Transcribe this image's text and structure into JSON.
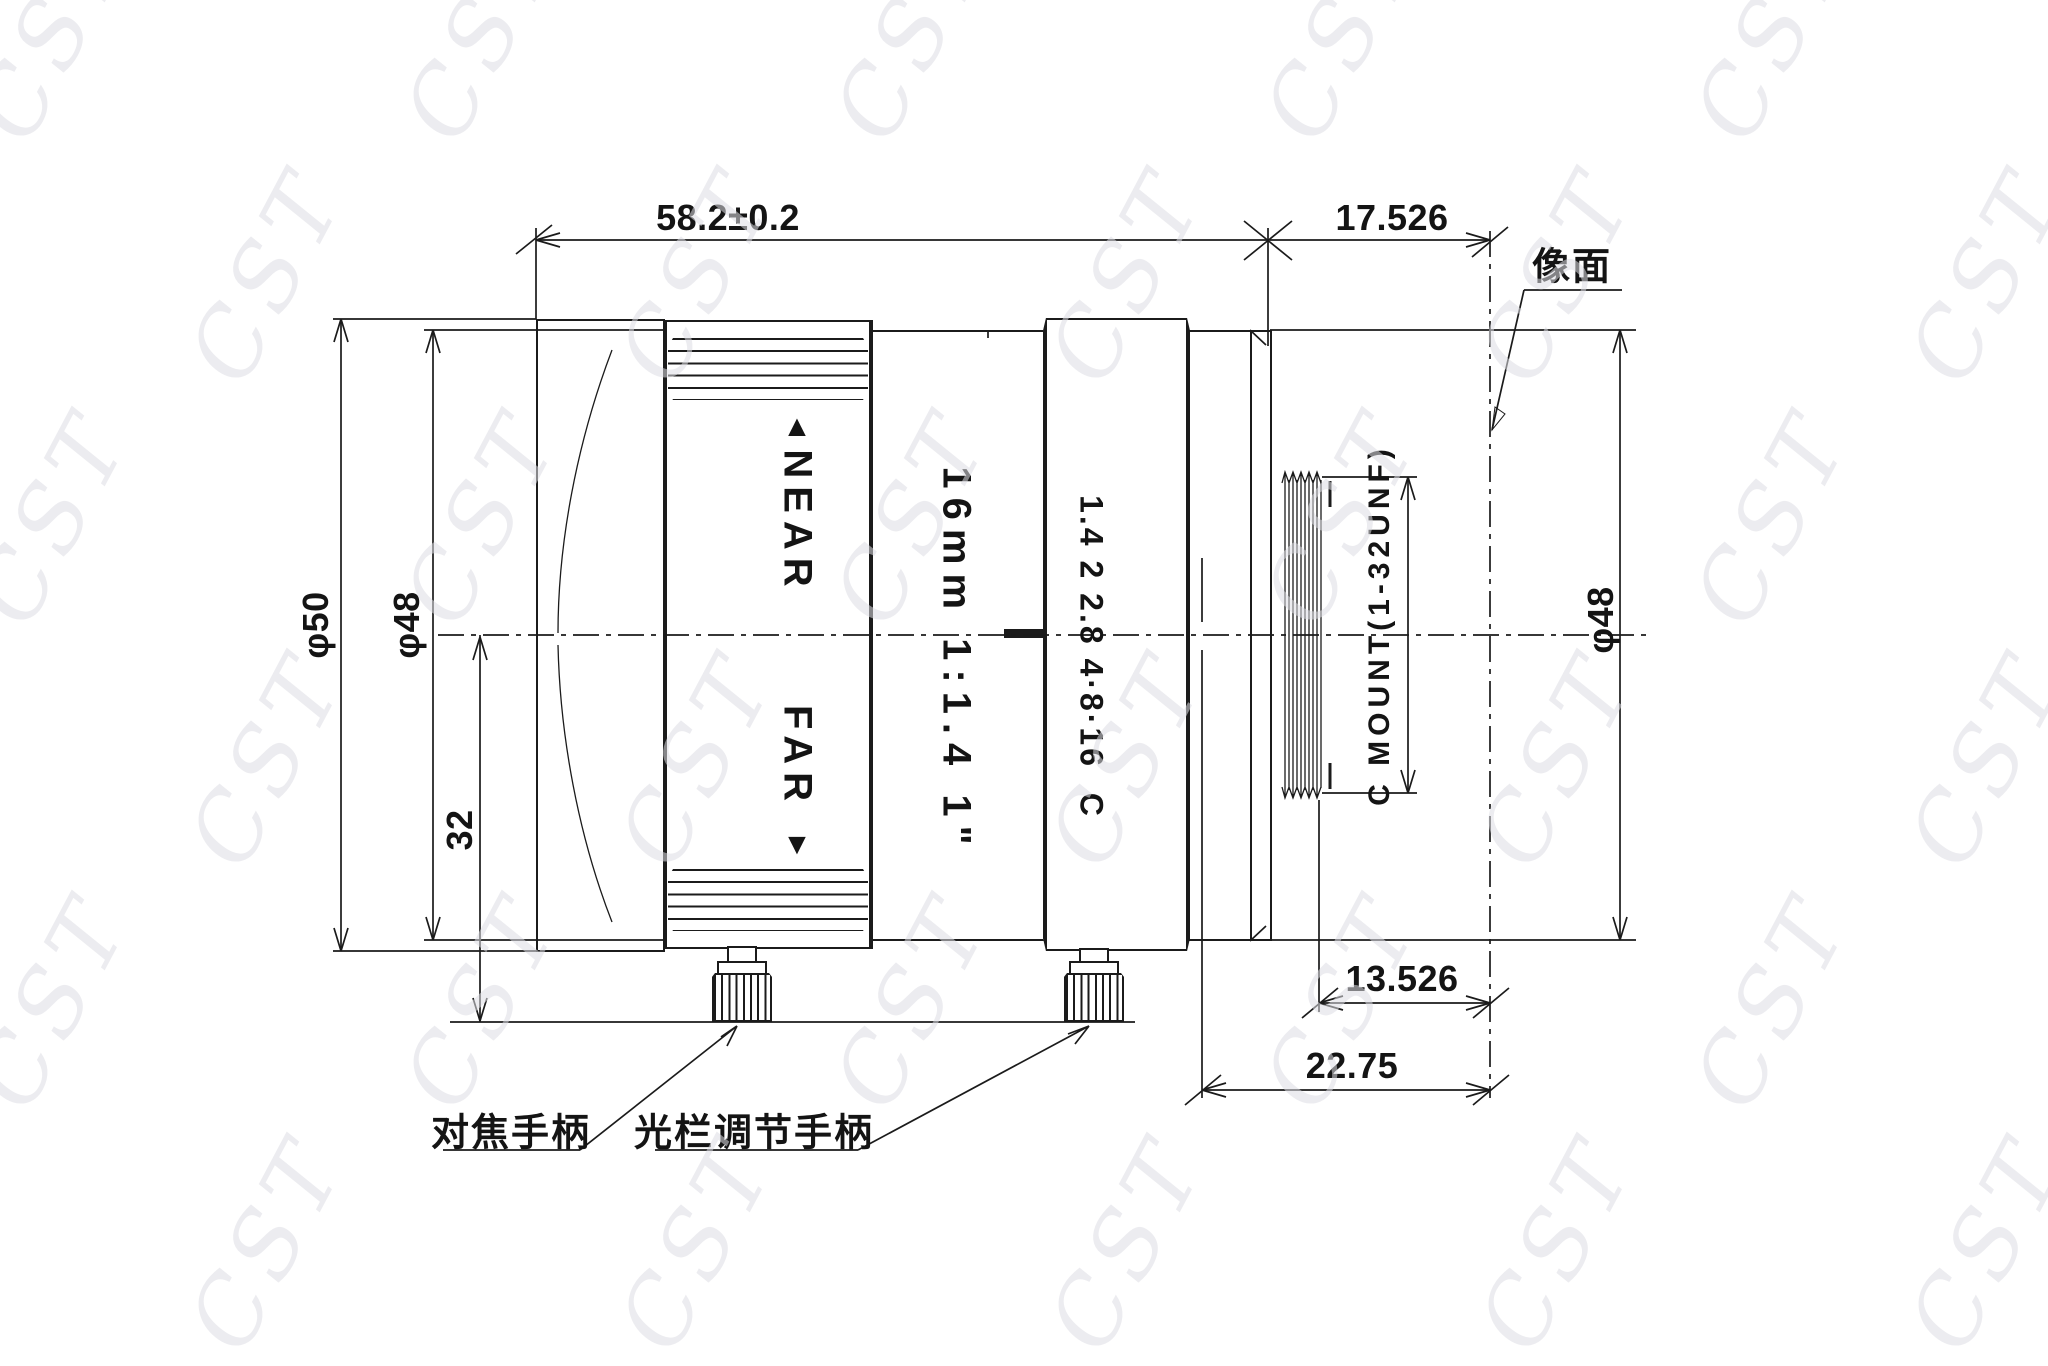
{
  "watermark": "CST",
  "dimensions": {
    "body_length": "58.2±0.2",
    "flange_back": "17.526",
    "thread_to_image": "13.526",
    "back_focal": "22.75",
    "front_diameter": "φ50",
    "barrel_diameter": "φ48",
    "rear_diameter": "φ48",
    "handle_offset": "32",
    "mount_thread": "C MOUNT(1-32UNF)"
  },
  "lens_markings": {
    "near_arrow": "▲",
    "near": "NEAR",
    "far": "FAR",
    "far_arrow": "▼",
    "focal_spec": "16mm 1:1.4 1\"",
    "aperture_scale": "1.4 2 2.8 4·8·16  C"
  },
  "annotations": {
    "image_plane": "像面",
    "focus_handle": "对焦手柄",
    "iris_handle": "光栏调节手柄"
  }
}
